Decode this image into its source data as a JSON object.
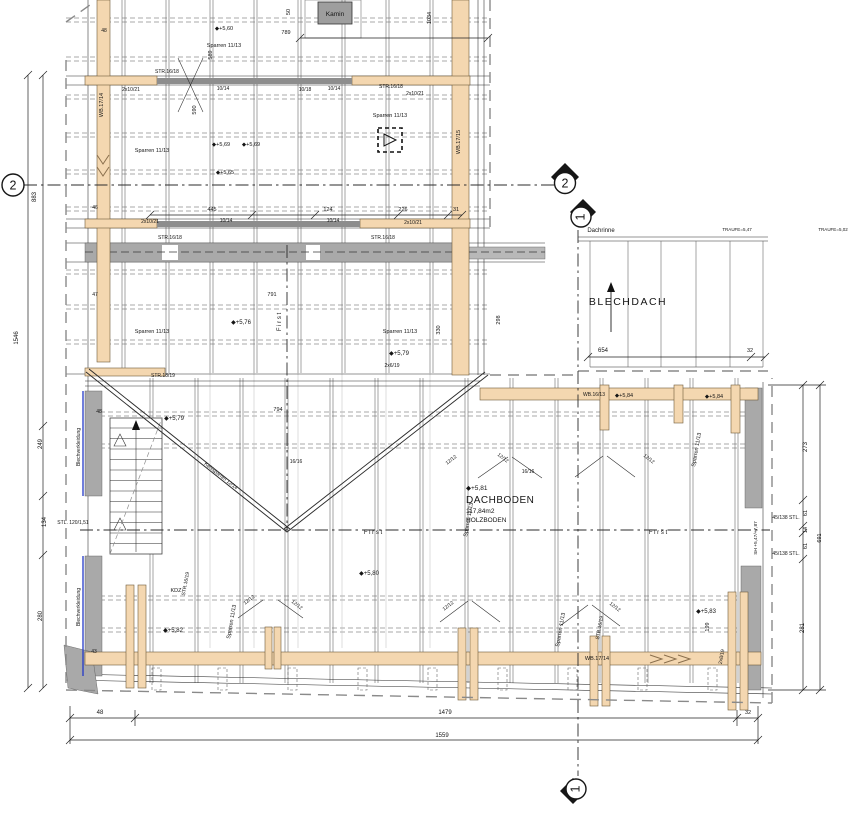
{
  "axes": [
    {
      "label": "2"
    },
    {
      "label": "2"
    },
    {
      "label": "1"
    },
    {
      "label": "1"
    }
  ],
  "colors": {
    "beam_wood": "#f4d7b0",
    "masonry_gray": "#a9a9a9",
    "cladding_blue": "#2438c8",
    "line": "#2b2b2b"
  },
  "labels": [
    {
      "t": "1546",
      "x": 18,
      "y": 338,
      "r": -90,
      "n": "dim-overall-left"
    },
    {
      "t": "883",
      "x": 36,
      "y": 197,
      "r": -90,
      "n": "dim"
    },
    {
      "t": "249",
      "x": 42,
      "y": 444,
      "r": -90,
      "n": "dim"
    },
    {
      "t": "134",
      "x": 46,
      "y": 522,
      "r": -90,
      "n": "dim"
    },
    {
      "t": "280",
      "x": 42,
      "y": 616,
      "r": -90,
      "n": "dim"
    },
    {
      "t": "47",
      "x": 95,
      "y": 296,
      "s": 5,
      "n": "dim"
    },
    {
      "t": "48",
      "x": 99,
      "y": 413,
      "s": 5,
      "n": "dim"
    },
    {
      "t": "43",
      "x": 94,
      "y": 653,
      "s": 5,
      "n": "dim"
    },
    {
      "t": "48",
      "x": 104,
      "y": 32,
      "s": 5,
      "n": "dim"
    },
    {
      "t": "46",
      "x": 95,
      "y": 209,
      "s": 5,
      "n": "dim"
    },
    {
      "t": "48",
      "x": 100,
      "y": 714,
      "n": "dim"
    },
    {
      "t": "1479",
      "x": 445,
      "y": 714,
      "n": "dim"
    },
    {
      "t": "32",
      "x": 748,
      "y": 714,
      "s": 5.5,
      "n": "dim"
    },
    {
      "t": "1559",
      "x": 442,
      "y": 737,
      "n": "dim-overall-bottom"
    },
    {
      "t": "445",
      "x": 212,
      "y": 211,
      "s": 5.5,
      "n": "dim"
    },
    {
      "t": "124",
      "x": 328,
      "y": 211,
      "s": 5.5,
      "n": "dim"
    },
    {
      "t": "226",
      "x": 403,
      "y": 211,
      "s": 5.5,
      "n": "dim"
    },
    {
      "t": "31",
      "x": 456,
      "y": 211,
      "s": 5.5,
      "n": "dim"
    },
    {
      "t": "791",
      "x": 272,
      "y": 296,
      "s": 5.5,
      "n": "dim"
    },
    {
      "t": "794",
      "x": 278,
      "y": 411,
      "s": 5.5,
      "n": "dim"
    },
    {
      "t": "789",
      "x": 286,
      "y": 34,
      "s": 5.5,
      "n": "dim"
    },
    {
      "t": "50",
      "x": 290,
      "y": 12,
      "r": -90,
      "s": 5.5,
      "n": "dim"
    },
    {
      "t": "589",
      "x": 212,
      "y": 55,
      "r": -90,
      "s": 5.5,
      "n": "dim"
    },
    {
      "t": "590",
      "x": 196,
      "y": 110,
      "r": -90,
      "s": 5.5,
      "n": "dim"
    },
    {
      "t": "1034",
      "x": 431,
      "y": 18,
      "r": -90,
      "s": 5.5,
      "n": "dim"
    },
    {
      "t": "654",
      "x": 603,
      "y": 352,
      "n": "dim"
    },
    {
      "t": "32",
      "x": 750,
      "y": 352,
      "s": 5.5,
      "n": "dim"
    },
    {
      "t": "273",
      "x": 807,
      "y": 447,
      "r": -90,
      "n": "dim"
    },
    {
      "t": "61",
      "x": 807,
      "y": 513,
      "r": -90,
      "s": 5.5,
      "n": "dim"
    },
    {
      "t": "14",
      "x": 807,
      "y": 530,
      "r": -90,
      "s": 5.5,
      "n": "dim"
    },
    {
      "t": "61",
      "x": 807,
      "y": 546,
      "r": -90,
      "s": 5.5,
      "n": "dim"
    },
    {
      "t": "281",
      "x": 804,
      "y": 628,
      "r": -90,
      "n": "dim"
    },
    {
      "t": "691",
      "x": 821,
      "y": 538,
      "r": -90,
      "s": 5.5,
      "n": "dim-overall-right"
    },
    {
      "t": "298",
      "x": 500,
      "y": 320,
      "r": -90,
      "s": 5.5,
      "n": "dim"
    },
    {
      "t": "330",
      "x": 440,
      "y": 330,
      "r": -90,
      "s": 5.5,
      "n": "dim"
    },
    {
      "t": "199",
      "x": 709,
      "y": 627,
      "r": -90,
      "s": 5.5,
      "n": "dim"
    },
    {
      "t": "STL. 120/1,51",
      "x": 73,
      "y": 524,
      "s": 5,
      "n": "steel-column-note"
    },
    {
      "t": "45/138 STL.",
      "x": 786,
      "y": 519,
      "s": 5,
      "n": "steel-column-note"
    },
    {
      "t": "45/138 STL.",
      "x": 786,
      "y": 555,
      "s": 5,
      "n": "steel-column-note"
    },
    {
      "t": "SH +5,47/+7,87",
      "x": 757,
      "y": 538,
      "r": -90,
      "s": 4.8,
      "n": "height-note"
    },
    {
      "t": "WB.17/14",
      "x": 103,
      "y": 105,
      "r": -90,
      "s": 5.5,
      "n": "beam-label"
    },
    {
      "t": "WB.17/15",
      "x": 460,
      "y": 142,
      "r": -90,
      "s": 5.5,
      "n": "beam-label"
    },
    {
      "t": "WB.17/14",
      "x": 597,
      "y": 660,
      "s": 5.5,
      "n": "beam-label"
    },
    {
      "t": "WB.16/13",
      "x": 594,
      "y": 396,
      "s": 5,
      "n": "beam-label"
    },
    {
      "t": "STR.16/18",
      "x": 167,
      "y": 73,
      "s": 5,
      "n": "member-label"
    },
    {
      "t": "2x10/21",
      "x": 131,
      "y": 91,
      "s": 5,
      "n": "member-label"
    },
    {
      "t": "10/14",
      "x": 223,
      "y": 90,
      "s": 5,
      "n": "member-label"
    },
    {
      "t": "10/18",
      "x": 305,
      "y": 91,
      "s": 5,
      "n": "member-label"
    },
    {
      "t": "10/14",
      "x": 334,
      "y": 90,
      "s": 5,
      "n": "member-label"
    },
    {
      "t": "STR.16/18",
      "x": 391,
      "y": 88,
      "s": 5,
      "n": "member-label"
    },
    {
      "t": "2x10/21",
      "x": 415,
      "y": 95,
      "s": 5,
      "n": "member-label"
    },
    {
      "t": "STR.16/18",
      "x": 170,
      "y": 239,
      "s": 5,
      "n": "member-label"
    },
    {
      "t": "2x10/21",
      "x": 150,
      "y": 223,
      "s": 5,
      "n": "member-label"
    },
    {
      "t": "10/14",
      "x": 226,
      "y": 222,
      "s": 5,
      "n": "member-label"
    },
    {
      "t": "10/14",
      "x": 333,
      "y": 222,
      "s": 5,
      "n": "member-label"
    },
    {
      "t": "STR.16/18",
      "x": 383,
      "y": 239,
      "s": 5,
      "n": "member-label"
    },
    {
      "t": "2x10/21",
      "x": 413,
      "y": 224,
      "s": 5,
      "n": "member-label"
    },
    {
      "t": "Sparren 11/13",
      "x": 152,
      "y": 152,
      "s": 5.5,
      "n": "rafter-label"
    },
    {
      "t": "Sparren 11/13",
      "x": 224,
      "y": 47,
      "s": 5.5,
      "n": "rafter-label"
    },
    {
      "t": "Sparren 11/13",
      "x": 390,
      "y": 117,
      "s": 5.5,
      "n": "rafter-label"
    },
    {
      "t": "Sparren 11/13",
      "x": 152,
      "y": 333,
      "s": 5.5,
      "n": "rafter-label"
    },
    {
      "t": "Sparren 11/13",
      "x": 400,
      "y": 333,
      "s": 5.5,
      "n": "rafter-label"
    },
    {
      "t": "Sparren 11/13",
      "x": 233,
      "y": 622,
      "r": -80,
      "s": 5.5,
      "n": "rafter-label"
    },
    {
      "t": "Sparren 11/13",
      "x": 470,
      "y": 520,
      "r": -80,
      "s": 5.5,
      "n": "rafter-label"
    },
    {
      "t": "Sparren 11/13",
      "x": 562,
      "y": 630,
      "r": -80,
      "s": 5.5,
      "n": "rafter-label"
    },
    {
      "t": "Sparren 11/13",
      "x": 698,
      "y": 450,
      "r": -80,
      "s": 5.5,
      "n": "rafter-label"
    },
    {
      "t": "STR.18/19",
      "x": 163,
      "y": 377,
      "s": 5,
      "n": "member-label"
    },
    {
      "t": "STR.16/19",
      "x": 601,
      "y": 628,
      "r": -80,
      "s": 5,
      "n": "member-label"
    },
    {
      "t": "STR.16/19",
      "x": 187,
      "y": 584,
      "r": -80,
      "s": 5,
      "n": "member-label"
    },
    {
      "t": "Kehlsparren 12/14",
      "x": 220,
      "y": 477,
      "r": 38,
      "s": 5,
      "n": "valley-rafter-label"
    },
    {
      "t": "12/12",
      "x": 250,
      "y": 601,
      "r": -38,
      "s": 5,
      "n": "brace-label"
    },
    {
      "t": "12/12",
      "x": 296,
      "y": 606,
      "r": 38,
      "s": 5,
      "n": "brace-label"
    },
    {
      "t": "12/12",
      "x": 449,
      "y": 607,
      "r": -38,
      "s": 5,
      "n": "brace-label"
    },
    {
      "t": "12/12",
      "x": 614,
      "y": 608,
      "r": 38,
      "s": 5,
      "n": "brace-label"
    },
    {
      "t": "12/12",
      "x": 452,
      "y": 461,
      "r": -38,
      "s": 5,
      "n": "brace-label"
    },
    {
      "t": "12/12",
      "x": 502,
      "y": 459,
      "r": 38,
      "s": 5,
      "n": "brace-label"
    },
    {
      "t": "12/12",
      "x": 648,
      "y": 460,
      "r": 38,
      "s": 5,
      "n": "brace-label"
    },
    {
      "t": "16/16",
      "x": 528,
      "y": 473,
      "s": 5,
      "n": "member-label"
    },
    {
      "t": "16/16",
      "x": 296,
      "y": 463,
      "s": 5,
      "n": "member-label"
    },
    {
      "t": "2x8/19",
      "x": 723,
      "y": 657,
      "r": -80,
      "s": 5,
      "n": "member-label"
    },
    {
      "t": "2x6/19",
      "x": 392,
      "y": 367,
      "s": 5,
      "n": "member-label"
    },
    {
      "t": "KDZ",
      "x": 176,
      "y": 592,
      "s": 5.5,
      "n": "member-label"
    },
    {
      "t": "◆+5,60",
      "x": 224,
      "y": 30,
      "s": 5.5,
      "n": "level-marker"
    },
    {
      "t": "◆+5,69",
      "x": 221,
      "y": 146,
      "s": 5.5,
      "n": "level-marker"
    },
    {
      "t": "◆+5,69",
      "x": 251,
      "y": 146,
      "s": 5.5,
      "n": "level-marker"
    },
    {
      "t": "◆+5,65",
      "x": 225,
      "y": 174,
      "s": 5.5,
      "n": "level-marker"
    },
    {
      "t": "◆+5,76",
      "x": 241,
      "y": 324,
      "s": 6,
      "n": "level-marker"
    },
    {
      "t": "◆+5,79",
      "x": 174,
      "y": 420,
      "s": 6,
      "n": "level-marker"
    },
    {
      "t": "◆+5,79",
      "x": 399,
      "y": 355,
      "s": 6,
      "n": "level-marker"
    },
    {
      "t": "◆+5,80",
      "x": 369,
      "y": 575,
      "s": 6,
      "n": "level-marker"
    },
    {
      "t": "◆+5,82",
      "x": 173,
      "y": 632,
      "s": 6,
      "n": "level-marker"
    },
    {
      "t": "◆+5,83",
      "x": 706,
      "y": 613,
      "s": 6,
      "n": "level-marker"
    },
    {
      "t": "◆+5,84",
      "x": 624,
      "y": 397,
      "s": 5.5,
      "n": "level-marker"
    },
    {
      "t": "◆+5,84",
      "x": 714,
      "y": 398,
      "s": 5.5,
      "n": "level-marker"
    },
    {
      "t": "◆+5,81",
      "x": 466,
      "y": 490,
      "a": "s",
      "s": 6.5,
      "n": "level-marker"
    },
    {
      "t": "DACHBODEN",
      "x": 466,
      "y": 503,
      "a": "s",
      "s": 10,
      "ls": 0.5,
      "n": "room-name"
    },
    {
      "t": "117,84m2",
      "x": 466,
      "y": 513,
      "a": "s",
      "s": 6.5,
      "n": "room-area"
    },
    {
      "t": "HOLZBODEN",
      "x": 466,
      "y": 522,
      "a": "s",
      "s": 6.5,
      "n": "room-floor"
    },
    {
      "t": "BLECHDACH",
      "x": 628,
      "y": 305,
      "s": 10.5,
      "ls": 1.5,
      "n": "room-name"
    },
    {
      "t": "Kamin",
      "x": 335,
      "y": 16,
      "s": 6.5,
      "n": "chimney-label"
    },
    {
      "t": "Dachrinne",
      "x": 601,
      "y": 232,
      "s": 6,
      "n": "gutter-label"
    },
    {
      "t": "TRAUFE=5,47",
      "x": 737,
      "y": 231,
      "s": 4.5,
      "n": "eaves-note"
    },
    {
      "t": "TRAUFE=5,02",
      "x": 833,
      "y": 231,
      "s": 4.5,
      "n": "eaves-note"
    },
    {
      "t": "Blechverkleidung",
      "x": 80,
      "y": 447,
      "r": -90,
      "s": 5,
      "n": "cladding-label"
    },
    {
      "t": "Blechverkleidung",
      "x": 80,
      "y": 607,
      "r": -90,
      "s": 5,
      "n": "cladding-label"
    },
    {
      "t": "F i r s t",
      "x": 281,
      "y": 322,
      "r": -90,
      "s": 6,
      "n": "ridge-label"
    },
    {
      "t": "F i r s t",
      "x": 373,
      "y": 534,
      "s": 6,
      "n": "ridge-label"
    },
    {
      "t": "F i r s t",
      "x": 658,
      "y": 534,
      "s": 6,
      "n": "ridge-label"
    }
  ]
}
